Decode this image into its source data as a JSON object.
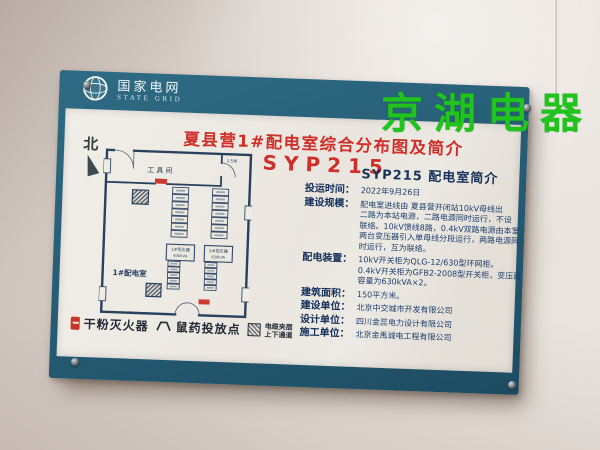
{
  "colors": {
    "board_teal": "#28607a",
    "title_red": "#cf2f28",
    "watermark_green": "#21c31d",
    "plan_line_navy": "#27415f"
  },
  "watermark": {
    "text": "京湖电器"
  },
  "header": {
    "brand_cn": "国家电网",
    "brand_en": "STATE GRID",
    "logo": "state-grid-globe-icon"
  },
  "board": {
    "title": "夏县营1#配电室综合分布图及简介",
    "code": "SYP215",
    "compass": "北",
    "plan": {
      "tool_room": "工具间",
      "dim_label": "2.5米",
      "room_label": "1#配电室",
      "transformer_1": "1#变压器",
      "transformer_1_sub": "630kVA",
      "transformer_2": "2#变压器",
      "transformer_2_sub": "630kVA",
      "cabinet_columns": {
        "upper_left_cells": 7,
        "upper_right_cells": 7,
        "lower_left_cells": 5,
        "lower_right_cells": 5
      },
      "markers": {
        "fire_extinguisher": "red-tag",
        "cable_duct": "hatched-square"
      }
    },
    "info": {
      "heading": "SYP215 配电室简介",
      "rows": [
        {
          "label": "投运时间：",
          "lines": [
            "2022年9月26日"
          ]
        },
        {
          "label": "建设规模：",
          "lines": [
            "配电室进线由 夏县营开闭站10kV母线出",
            "二路为本站电源，二路电源同时运行，不设",
            "联络。10kV馈线8路，0.4kV双路电源由本室",
            "两台变压器引入单母线分段运行，两路电源同",
            "时运行，互为联络。"
          ]
        },
        {
          "label": "配电装置：",
          "lines": [
            "10kV开关柜为QLG-12/630型环网柜。",
            "0.4kV开关柜为GFB2-2008型开关柜，变压器",
            "容量为630kVA×2。"
          ]
        },
        {
          "label": "建筑面积：",
          "lines": [
            "150平方米。"
          ]
        },
        {
          "label": "建设单位：",
          "lines": [
            "北京中交城市开发有限公司"
          ]
        },
        {
          "label": "设计单位：",
          "lines": [
            "四川金蕊电力设计有限公司"
          ]
        },
        {
          "label": "施工单位：",
          "lines": [
            "北京金禹诚电工程有限公司"
          ]
        }
      ]
    },
    "legend": {
      "items": [
        {
          "icon": "fire-extinguisher-marker",
          "label": "干粉灭火器"
        },
        {
          "icon": "rat-poison-marker",
          "label": "鼠药投放点"
        },
        {
          "icon": "cable-duct-hatch",
          "label_line1": "电缆夹层",
          "label_line2": "上下通道"
        }
      ]
    }
  }
}
